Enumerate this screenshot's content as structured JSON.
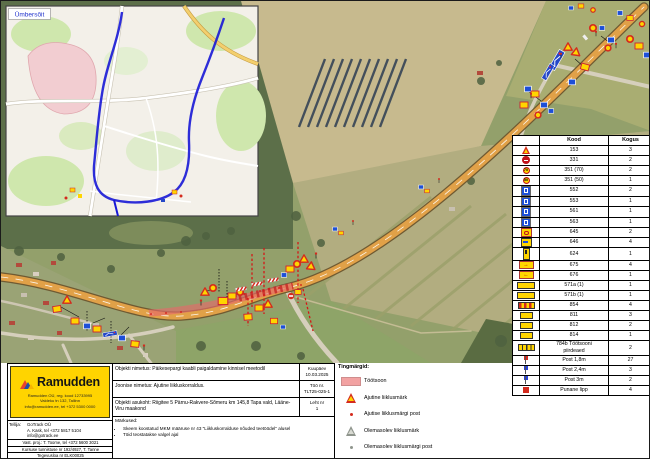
{
  "sheet": {
    "inset_label": "Ümbersõit"
  },
  "colors": {
    "ramudden_yellow": "#ffd400",
    "workzone_pink": "#f2a2a2",
    "detour_blue": "#1717d6",
    "sign_red": "#d42b1e",
    "sign_blue": "#1d4fd7",
    "road_orange": "#e1a148"
  },
  "sign_table": {
    "col_code": "Kood",
    "col_qty": "Kogus",
    "rows": [
      {
        "icon": "i-warn",
        "code": "153",
        "qty": "3"
      },
      {
        "icon": "i-noentry",
        "code": "331",
        "qty": "2"
      },
      {
        "icon": "i-ring",
        "t": "70",
        "code": "351 (70)",
        "qty": "2"
      },
      {
        "icon": "i-ring",
        "t": "50",
        "code": "351 (50)",
        "qty": "1"
      },
      {
        "icon": "i-blue",
        "code": "552",
        "qty": "2"
      },
      {
        "icon": "i-blue",
        "code": "553",
        "qty": "1"
      },
      {
        "icon": "i-blue",
        "code": "561",
        "qty": "1"
      },
      {
        "icon": "i-blue",
        "code": "563",
        "qty": "1"
      },
      {
        "icon": "i-yc",
        "code": "645",
        "qty": "2"
      },
      {
        "icon": "i-yr",
        "code": "646",
        "qty": "4"
      },
      {
        "icon": "i-tall",
        "code": "624",
        "qty": "1"
      },
      {
        "icon": "i-ar",
        "t": "→",
        "code": "675",
        "qty": "4"
      },
      {
        "icon": "i-al",
        "t": "←",
        "code": "676",
        "qty": "1"
      },
      {
        "icon": "i-panel",
        "code": "571a (1)",
        "qty": "1"
      },
      {
        "icon": "i-panel",
        "code": "571b (1)",
        "qty": "1"
      },
      {
        "icon": "i-stripe-ry",
        "code": "854",
        "qty": "4"
      },
      {
        "icon": "i-plate",
        "code": "811",
        "qty": "3"
      },
      {
        "icon": "i-plate",
        "code": "812",
        "qty": "2"
      },
      {
        "icon": "i-plate",
        "code": "814",
        "qty": "1"
      },
      {
        "icon": "i-stripe-yb",
        "code": "784b Töötsooni\npiirdeaed",
        "qty": "2"
      },
      {
        "icon": "i-post-red",
        "code": "Post 1,8m",
        "qty": "27"
      },
      {
        "icon": "i-post-blue",
        "code": "Post 2,4m",
        "qty": "3"
      },
      {
        "icon": "i-post-blue",
        "code": "Post 3m",
        "qty": "2"
      },
      {
        "icon": "i-flag-red",
        "code": "Punane lipp",
        "qty": "4"
      }
    ]
  },
  "legend": {
    "title": "Tingmärgid:",
    "items": [
      {
        "icon": "workzone",
        "label": "Töötsoon"
      },
      {
        "icon": "temp-sign",
        "label": "Ajutine liiklusmärk"
      },
      {
        "icon": "temp-post",
        "label": "Ajutise liiklusmärgi post"
      },
      {
        "icon": "existing-sign",
        "label": "Olemasolev liiklusmärk"
      },
      {
        "icon": "existing-post",
        "label": "Olemasolev liiklusmärgi post"
      }
    ]
  },
  "company": {
    "name": "Ramudden",
    "address_lines": [
      "Ramudden OÜ, reg. kood 12733995",
      "Valdeku tn 132, Tallinn",
      "info@ramudden.ee, tel +372 5300 0000"
    ]
  },
  "title_block": {
    "object_name": "Objekti nimetus: Päikesepargi kaabli paigaldamine kinnisel meetodil",
    "drawing_name": "Joonise nimetus: Ajutine liikluskorraldus.",
    "location": "Objekti asukoht: Riigitee 5 Pärnu-Rakvere-Sõmeru km 145,8 Tapa vald, Lääne-Viru maakond",
    "notes_title": "Märkused:",
    "notes": [
      "Skeem koostatud MKM määruse nr 43 \"Liikluskorralduse nõuded teetöödel\" alusel",
      "Töid teostatakse valgel ajal"
    ],
    "date_label": "Kuupäev",
    "date": "10.03.2025",
    "work_no_label": "Töö nr.",
    "work_no": "TLT25-025-1",
    "sheet_label": "Leht nr",
    "sheet_no": "1",
    "client_label": "Tellija:",
    "client_lines": [
      "GoTrack OÜ",
      "A. Kask, tel +372 5817 5104",
      "info@gotrack.ee"
    ],
    "responsible": "Vast. proj.: T. Toome, tel +372 5600 3021",
    "certificate": "Kursuse tunnistuse nr 192/4927, T. Tanne",
    "license": "Tegevusloa nr ELK00025"
  }
}
